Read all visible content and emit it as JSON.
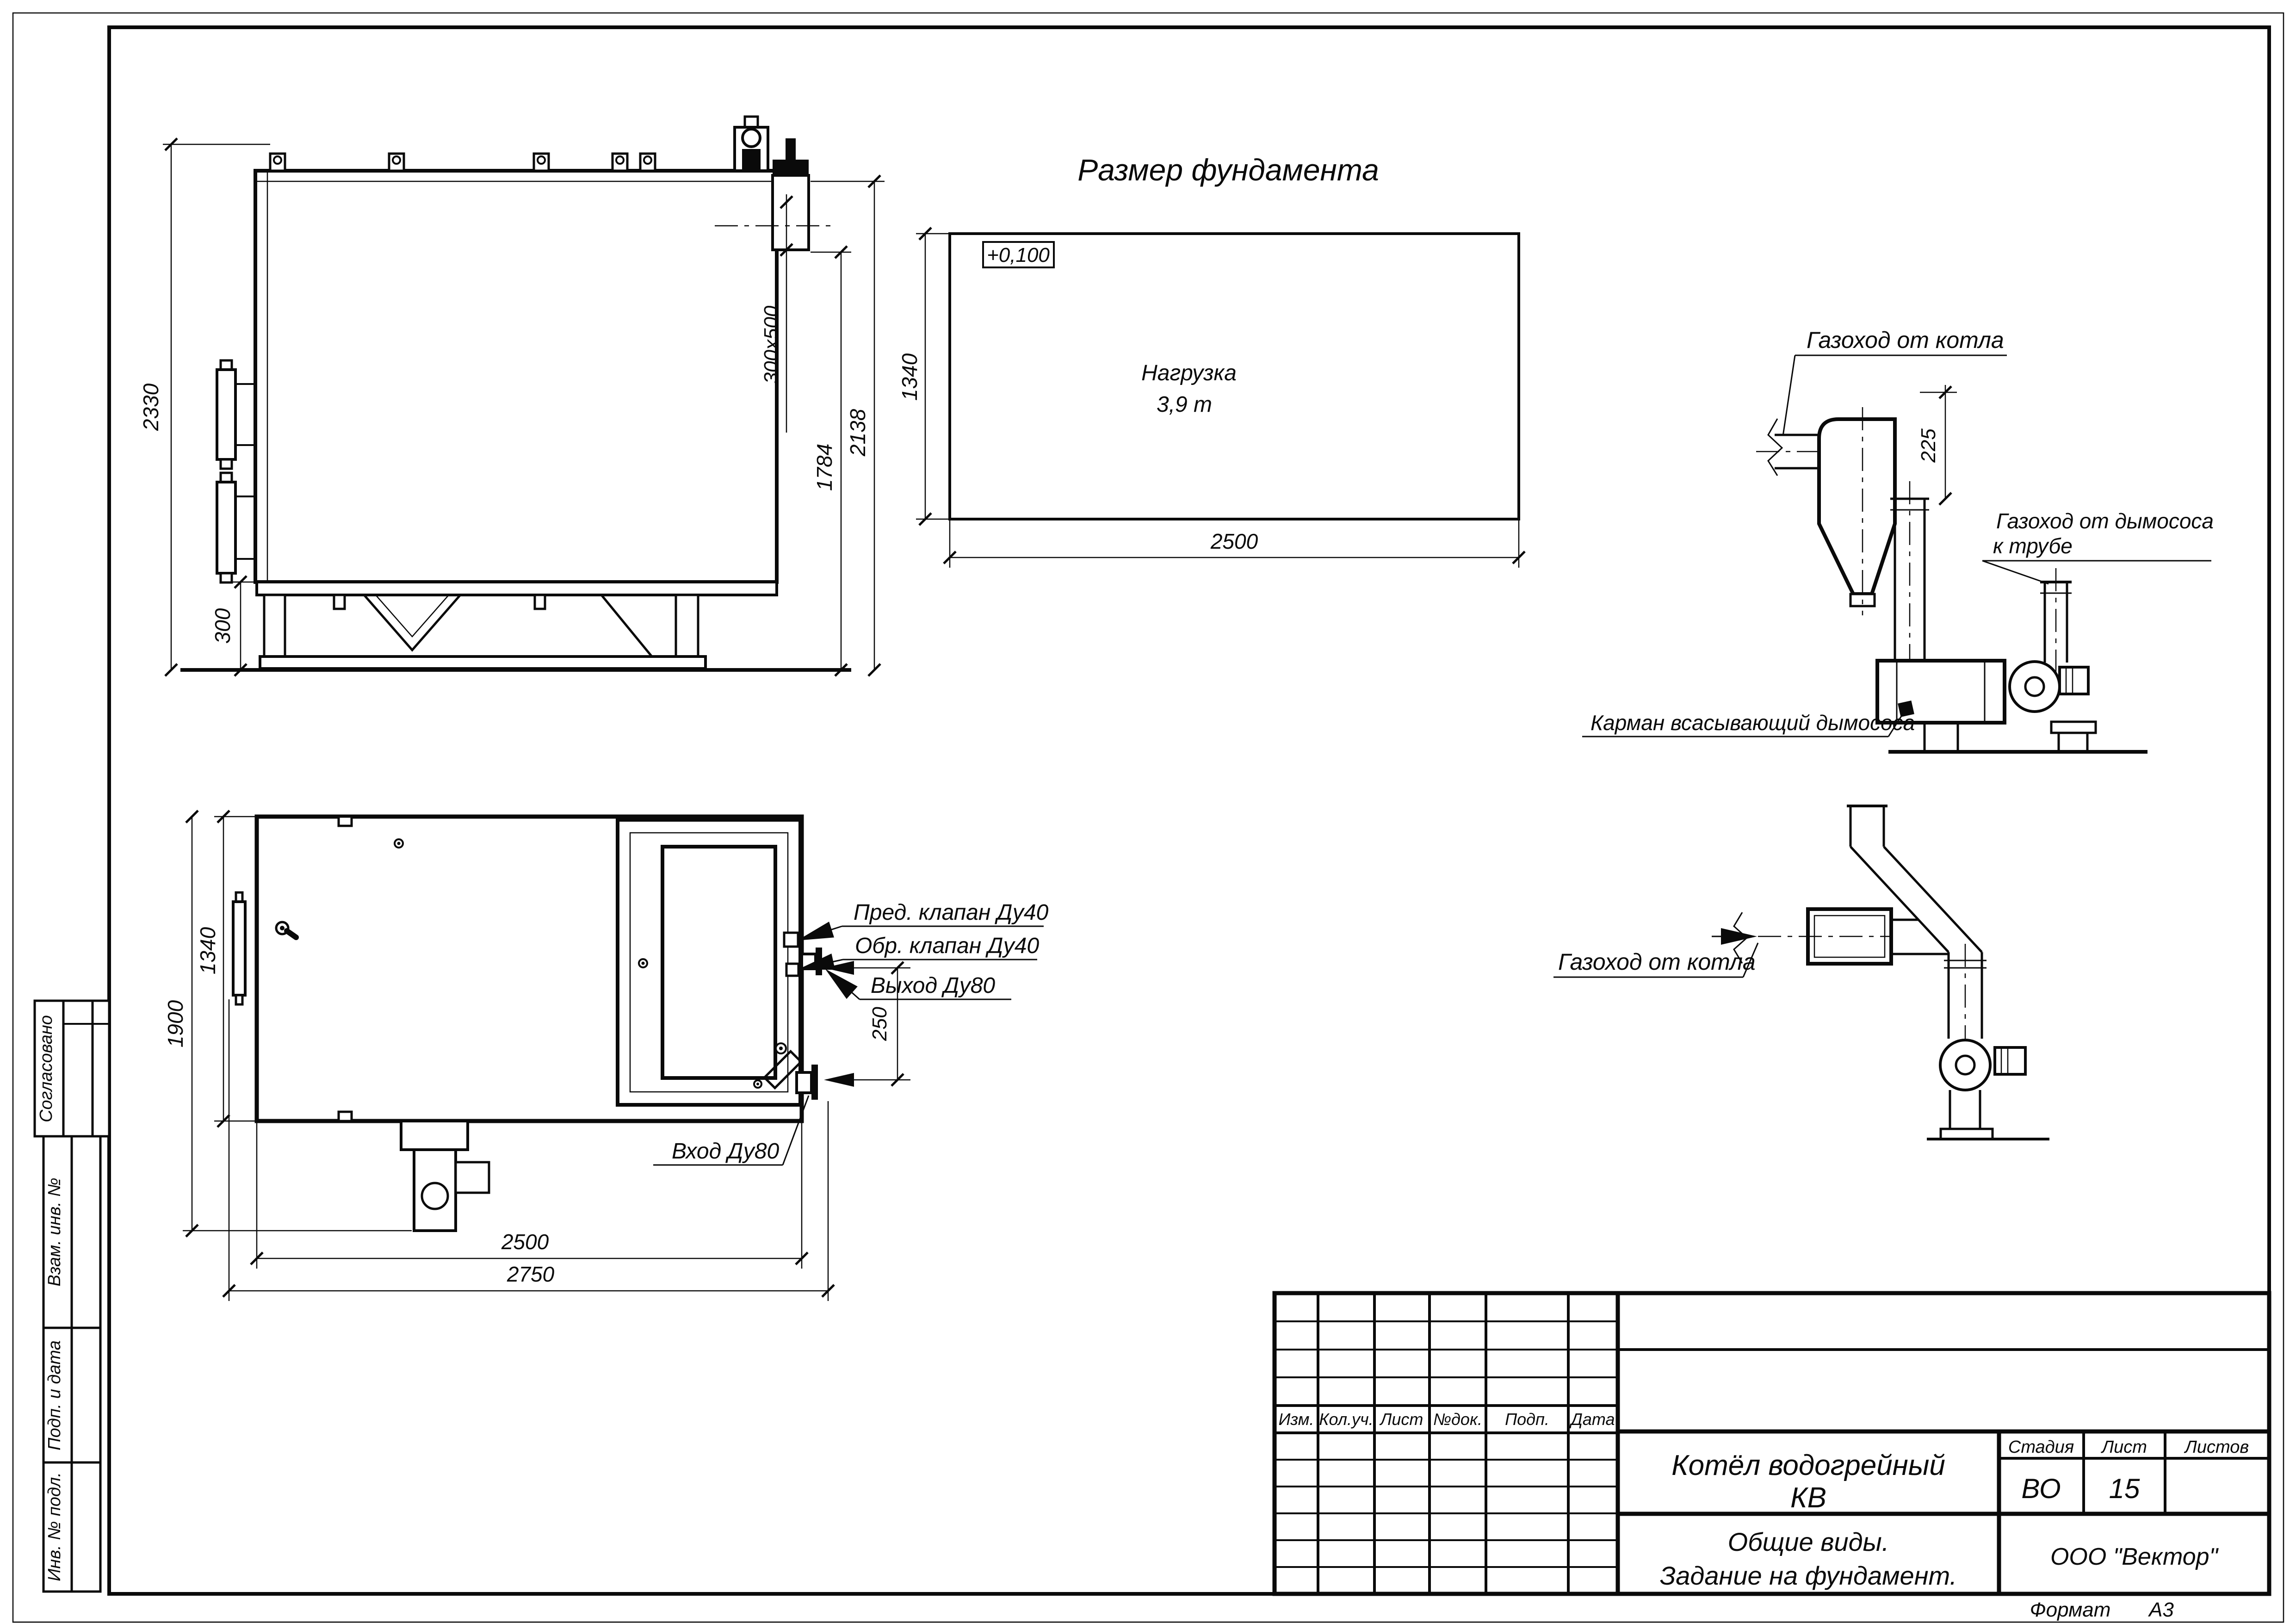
{
  "sheet": {
    "format_label": "Формат",
    "format_value": "А3"
  },
  "margin_labels": {
    "soglasovano": "Согласовано",
    "vzam_inv": "Взам. инв. №",
    "podp_data": "Подп. и дата",
    "inv_podl": "Инв. № подл."
  },
  "foundation_plan": {
    "title": "Размер фундамента",
    "elevation_mark": "+0,100",
    "load_line1": "Нагрузка",
    "load_line2": "3,9 т",
    "dim_width": "2500",
    "dim_depth": "1340"
  },
  "side_view": {
    "dim_total_height": "2330",
    "dim_base_height": "300",
    "dim_outlet": "300x500",
    "dim_2138": "2138",
    "dim_1784": "1784"
  },
  "plan_view": {
    "dim_1900": "1900",
    "dim_1340": "1340",
    "dim_2500": "2500",
    "dim_2750": "2750",
    "dim_250": "250",
    "label_safety_valve": "Пред. клапан Ду40",
    "label_check_valve": "Обр. клапан Ду40",
    "label_outlet": "Выход Ду80",
    "label_inlet": "Вход Ду80"
  },
  "flue_top": {
    "label_boiler_flue": "Газоход от котла",
    "dim_225": "225",
    "label_fan_flue_line1": "Газоход от дымососа",
    "label_fan_flue_line2": "к трубе",
    "label_pocket": "Карман всасывающий дымососа"
  },
  "flue_mid": {
    "label_boiler_flue": "Газоход от котла"
  },
  "title_block": {
    "rev_headers": [
      "Изм.",
      "Кол.уч.",
      "Лист",
      "№док.",
      "Подп.",
      "Дата"
    ],
    "doc_name_line1": "Котёл водогрейный",
    "doc_name_line2": "КВ",
    "stage_header": "Стадия",
    "sheet_header": "Лист",
    "sheets_header": "Листов",
    "stage_value": "ВО",
    "sheet_value": "15",
    "sheets_value": "",
    "subtitle_line1": "Общие виды.",
    "subtitle_line2": "Задание на фундамент.",
    "company": "ООО \"Вектор\""
  }
}
